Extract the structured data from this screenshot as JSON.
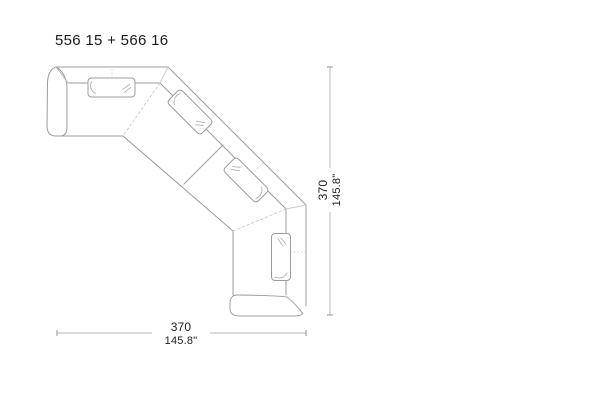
{
  "title": "556 15 + 566 16",
  "diagram": {
    "type": "sofa-plan-top-view",
    "description": "Technical plan (top view) line drawing of a corner sectional sofa composed of two modules",
    "modules": [
      "556 15",
      "566 16"
    ],
    "width_dimension": {
      "cm": "370",
      "inches": "145.8\""
    },
    "height_dimension": {
      "cm": "370",
      "inches": "145.8\""
    }
  },
  "style": {
    "background": "#ffffff",
    "outline_color": "#9c9c9c",
    "light_line_color": "#c9c9c9",
    "crease_color": "#b3b3b3",
    "dimension_line_color": "#b4b4b4",
    "text_color": "#1d1d1d"
  }
}
